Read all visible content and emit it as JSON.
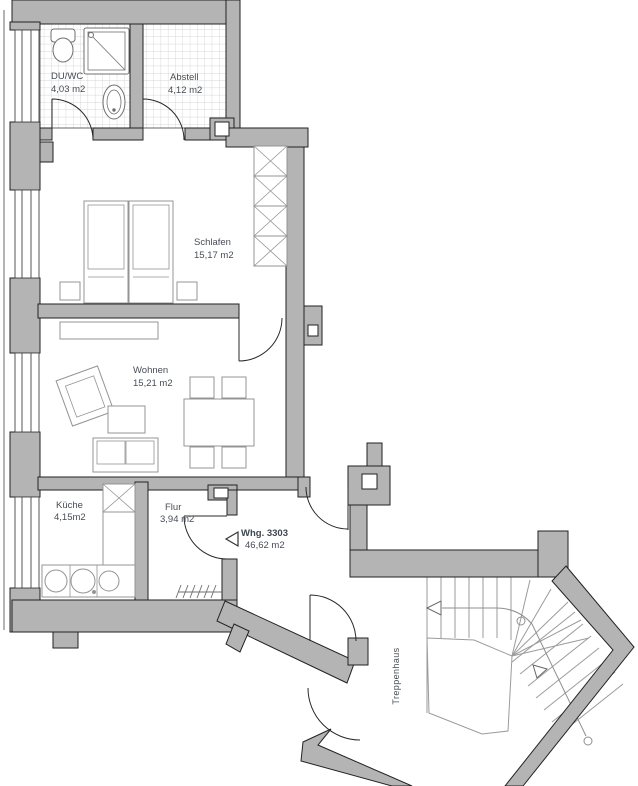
{
  "plan_title": "Apartment floor plan",
  "rooms": {
    "duwc": {
      "label": "DU/WC",
      "area": "4,03 m2"
    },
    "abstell": {
      "label": "Abstell",
      "area": "4,12 m2"
    },
    "schlafen": {
      "label": "Schlafen",
      "area": "15,17 m2"
    },
    "wohnen": {
      "label": "Wohnen",
      "area": "15,21 m2"
    },
    "kueche": {
      "label": "Küche",
      "area": "4,15m2"
    },
    "flur": {
      "label": "Flur",
      "area": "3,94 m2"
    },
    "treppenhaus": {
      "label": "Treppenhaus"
    }
  },
  "apartment": {
    "label": "Whg. 3303",
    "area": "46,62 m2"
  },
  "colors": {
    "wall": "#b4b4b4",
    "outline": "#222222",
    "furniture": "#949494",
    "tile": "#c9c9c9",
    "text": "#474d55",
    "stair": "#9b9b9b"
  }
}
